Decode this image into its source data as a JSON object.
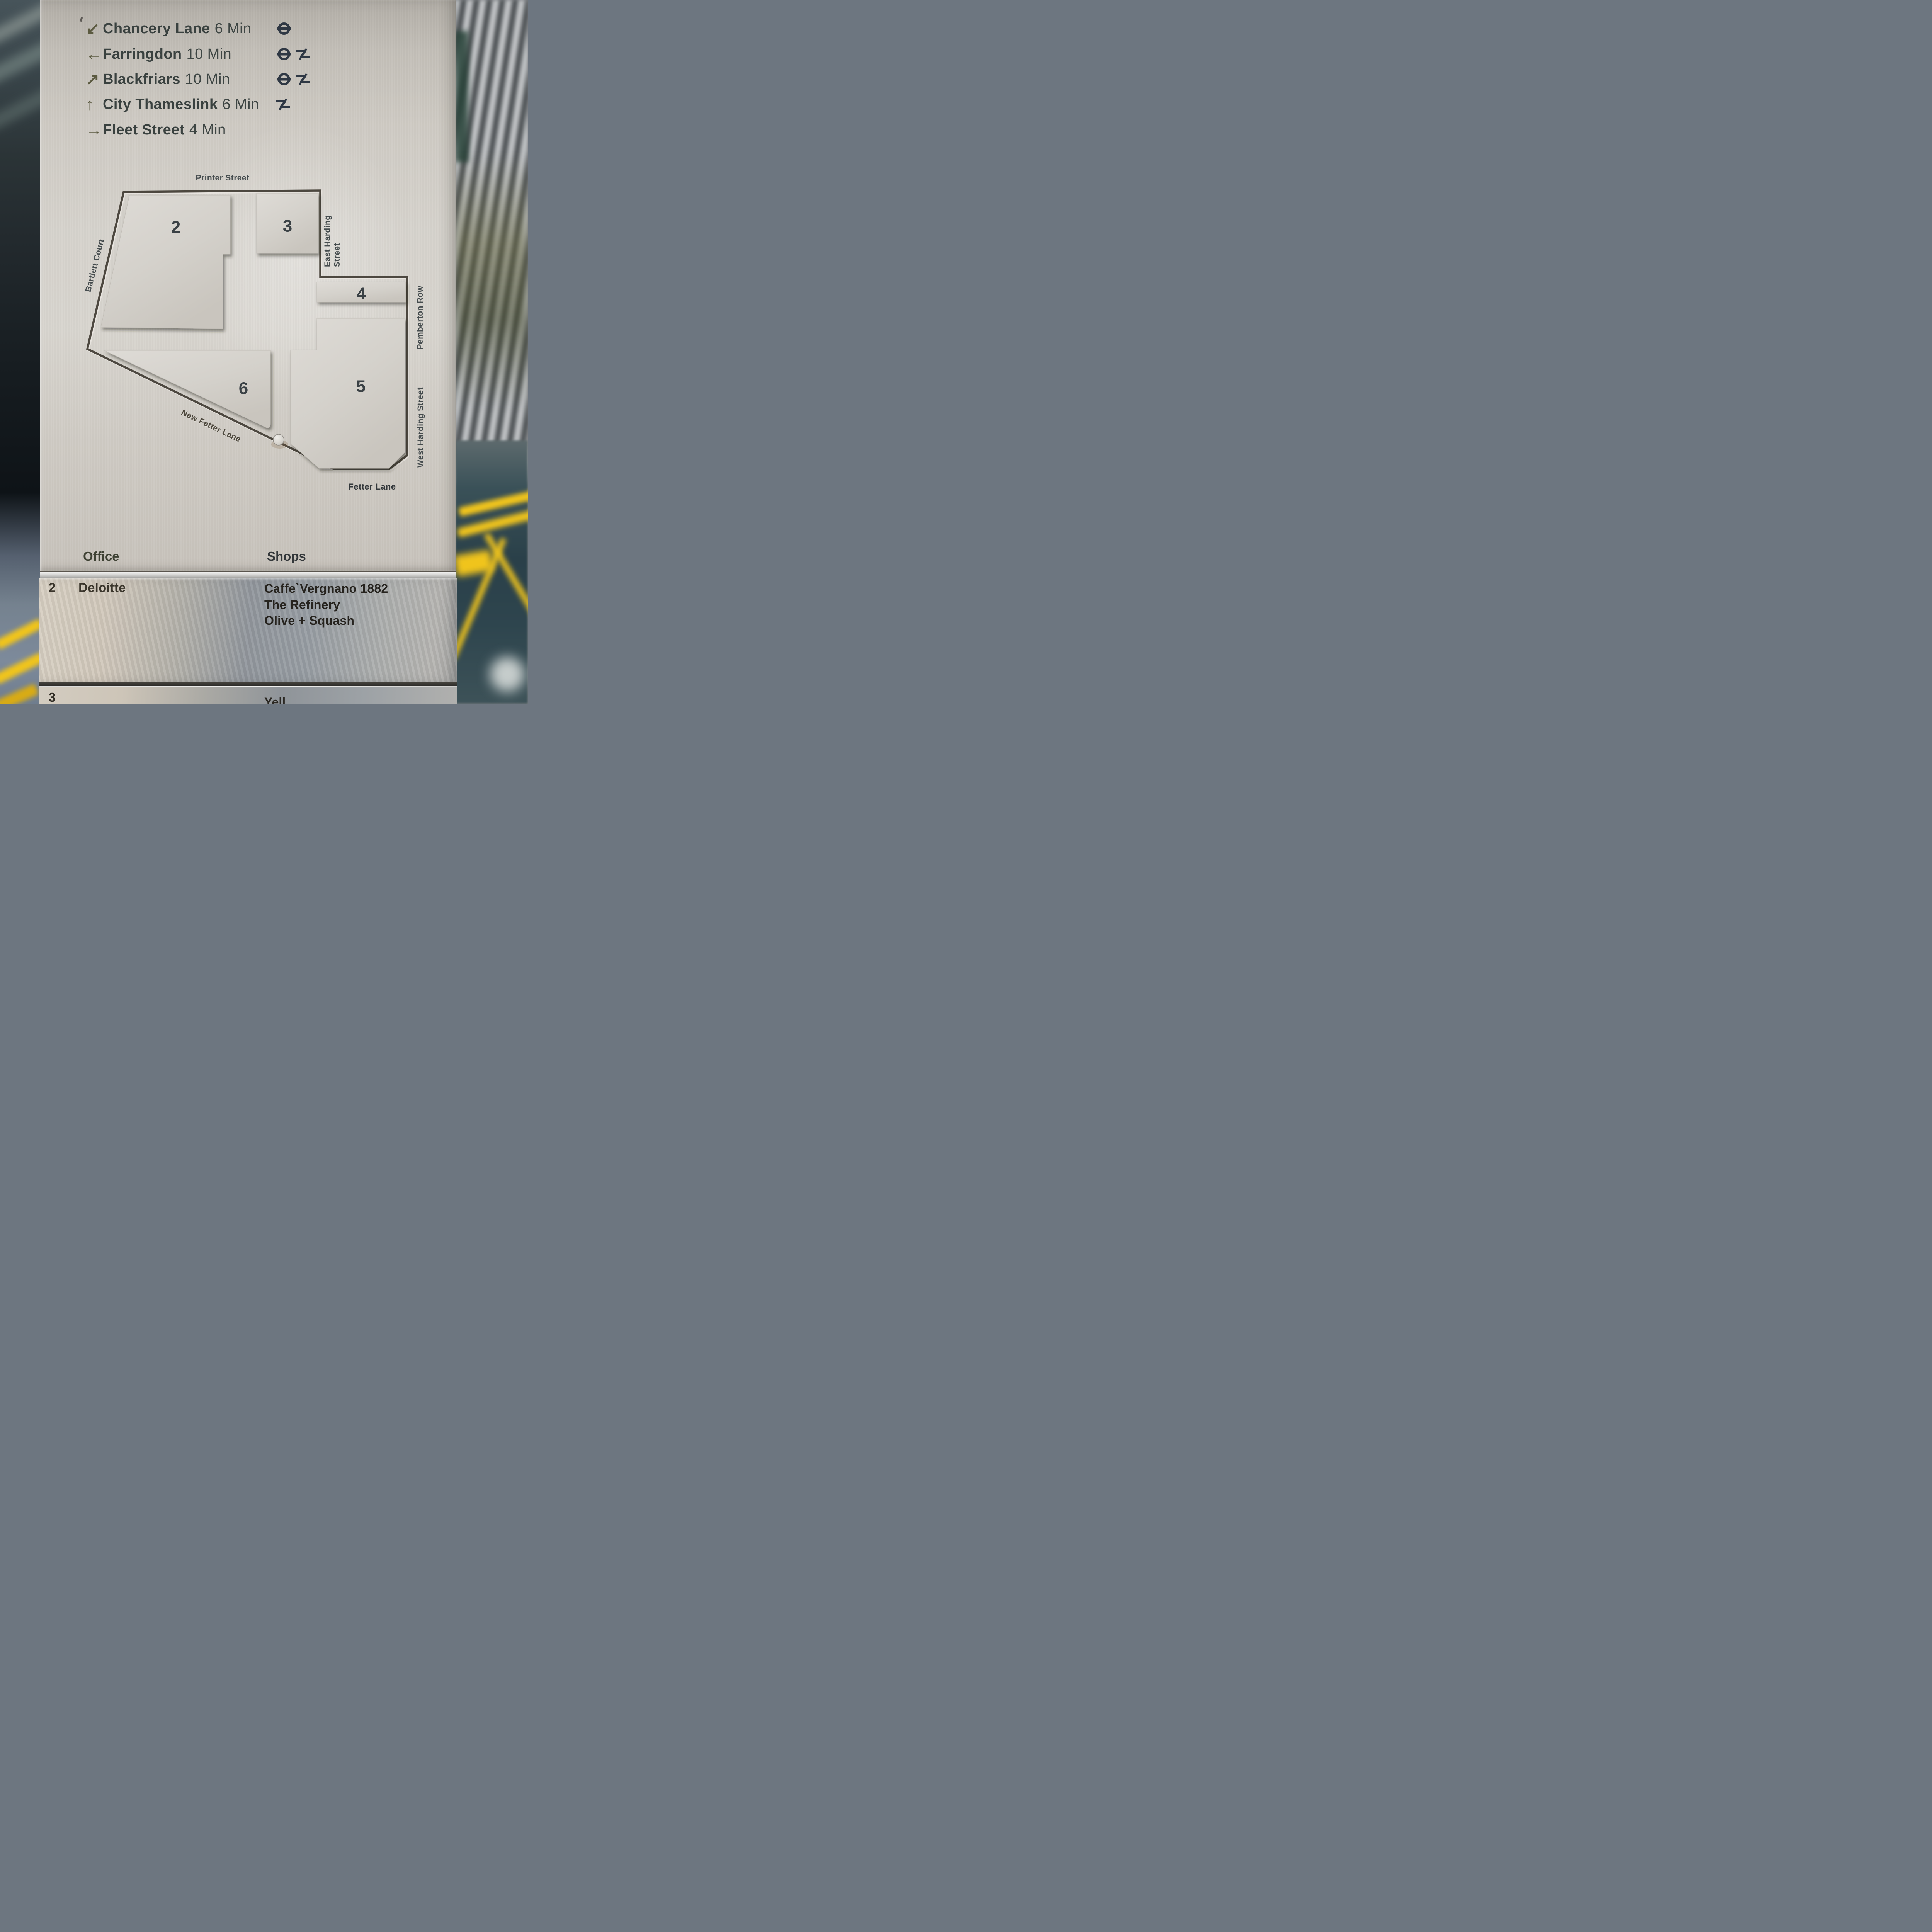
{
  "colors": {
    "accent_yellow": "#F0C41C",
    "panel_metal": "#D6D3CD",
    "band_steel": "#99A0A7",
    "text_dark": "#39413F",
    "arrow_olive": "#5B5A40",
    "engraving": "#45403A"
  },
  "directions": [
    {
      "arrow": "↙",
      "name": "Chancery Lane",
      "time": "6 Min",
      "icons": [
        "underground"
      ]
    },
    {
      "arrow": "←",
      "name": "Farringdon",
      "time": "10 Min",
      "icons": [
        "underground",
        "national-rail"
      ]
    },
    {
      "arrow": "↗",
      "name": "Blackfriars",
      "time": "10 Min",
      "icons": [
        "underground",
        "national-rail"
      ]
    },
    {
      "arrow": "↑",
      "name": "City Thameslink",
      "time": "6 Min",
      "icons": [
        "national-rail"
      ]
    },
    {
      "arrow": "→",
      "name": "Fleet Street",
      "time": "4 Min",
      "icons": []
    }
  ],
  "map": {
    "streets": {
      "printer": "Printer Street",
      "bartlett": "Bartlett Court",
      "east_harding": [
        "East Harding",
        "Street"
      ],
      "pemberton": "Pemberton Row",
      "west_harding": "West Harding Street",
      "new_fetter": "New Fetter Lane",
      "fetter": "Fetter Lane"
    },
    "buildings": [
      "2",
      "3",
      "4",
      "5",
      "6"
    ],
    "marker": "location-peg"
  },
  "directory": {
    "office_header": "Office",
    "shops_header": "Shops",
    "rows": [
      {
        "number": "2",
        "office": "Deloitte",
        "shops": [
          "Caffe`Vergnano 1882",
          "The Refinery",
          "Olive + Squash"
        ]
      },
      {
        "number": "3",
        "shops_partial": "Yell"
      }
    ]
  }
}
